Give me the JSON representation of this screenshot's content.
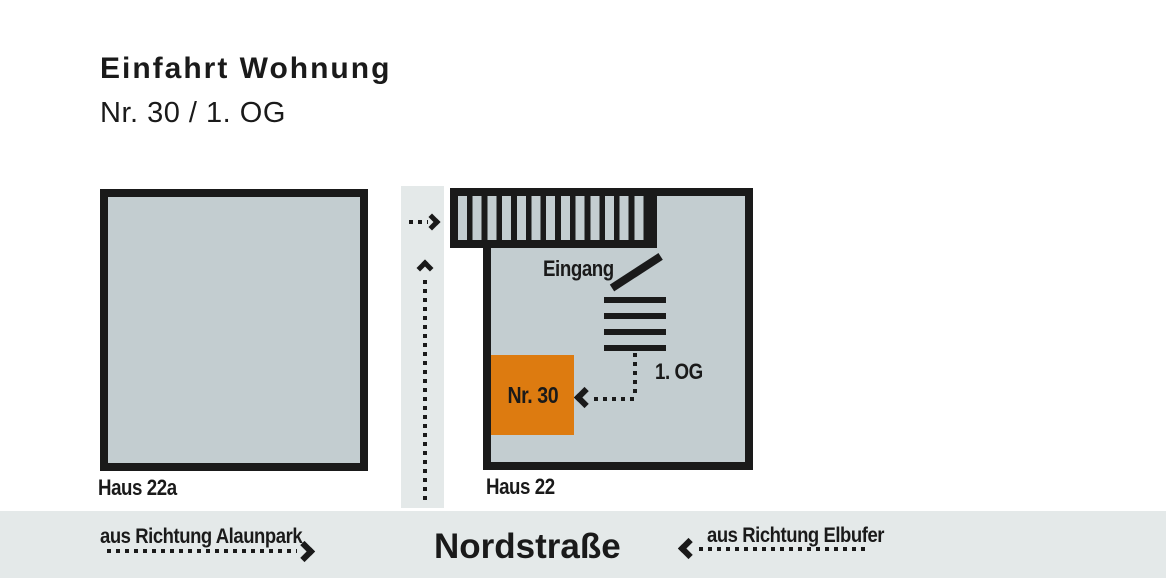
{
  "title": {
    "line1": "Einfahrt Wohnung",
    "line2": "Nr. 30 / 1. OG"
  },
  "buildings": {
    "left": {
      "label": "Haus 22a"
    },
    "right": {
      "label": "Haus 22"
    }
  },
  "annotations": {
    "entrance_label": "Eingang",
    "floor_label": "1. OG",
    "apartment_label": "Nr. 30"
  },
  "street": {
    "name": "Nordstraße",
    "direction_left": "aus Richtung Alaunpark",
    "direction_right": "aus Richtung Elbufer"
  },
  "colors": {
    "ink": "#1a1a1a",
    "building_fill": "#c3cdd0",
    "street_fill": "#e4e9e9",
    "apartment_orange": "#dd7b10"
  }
}
